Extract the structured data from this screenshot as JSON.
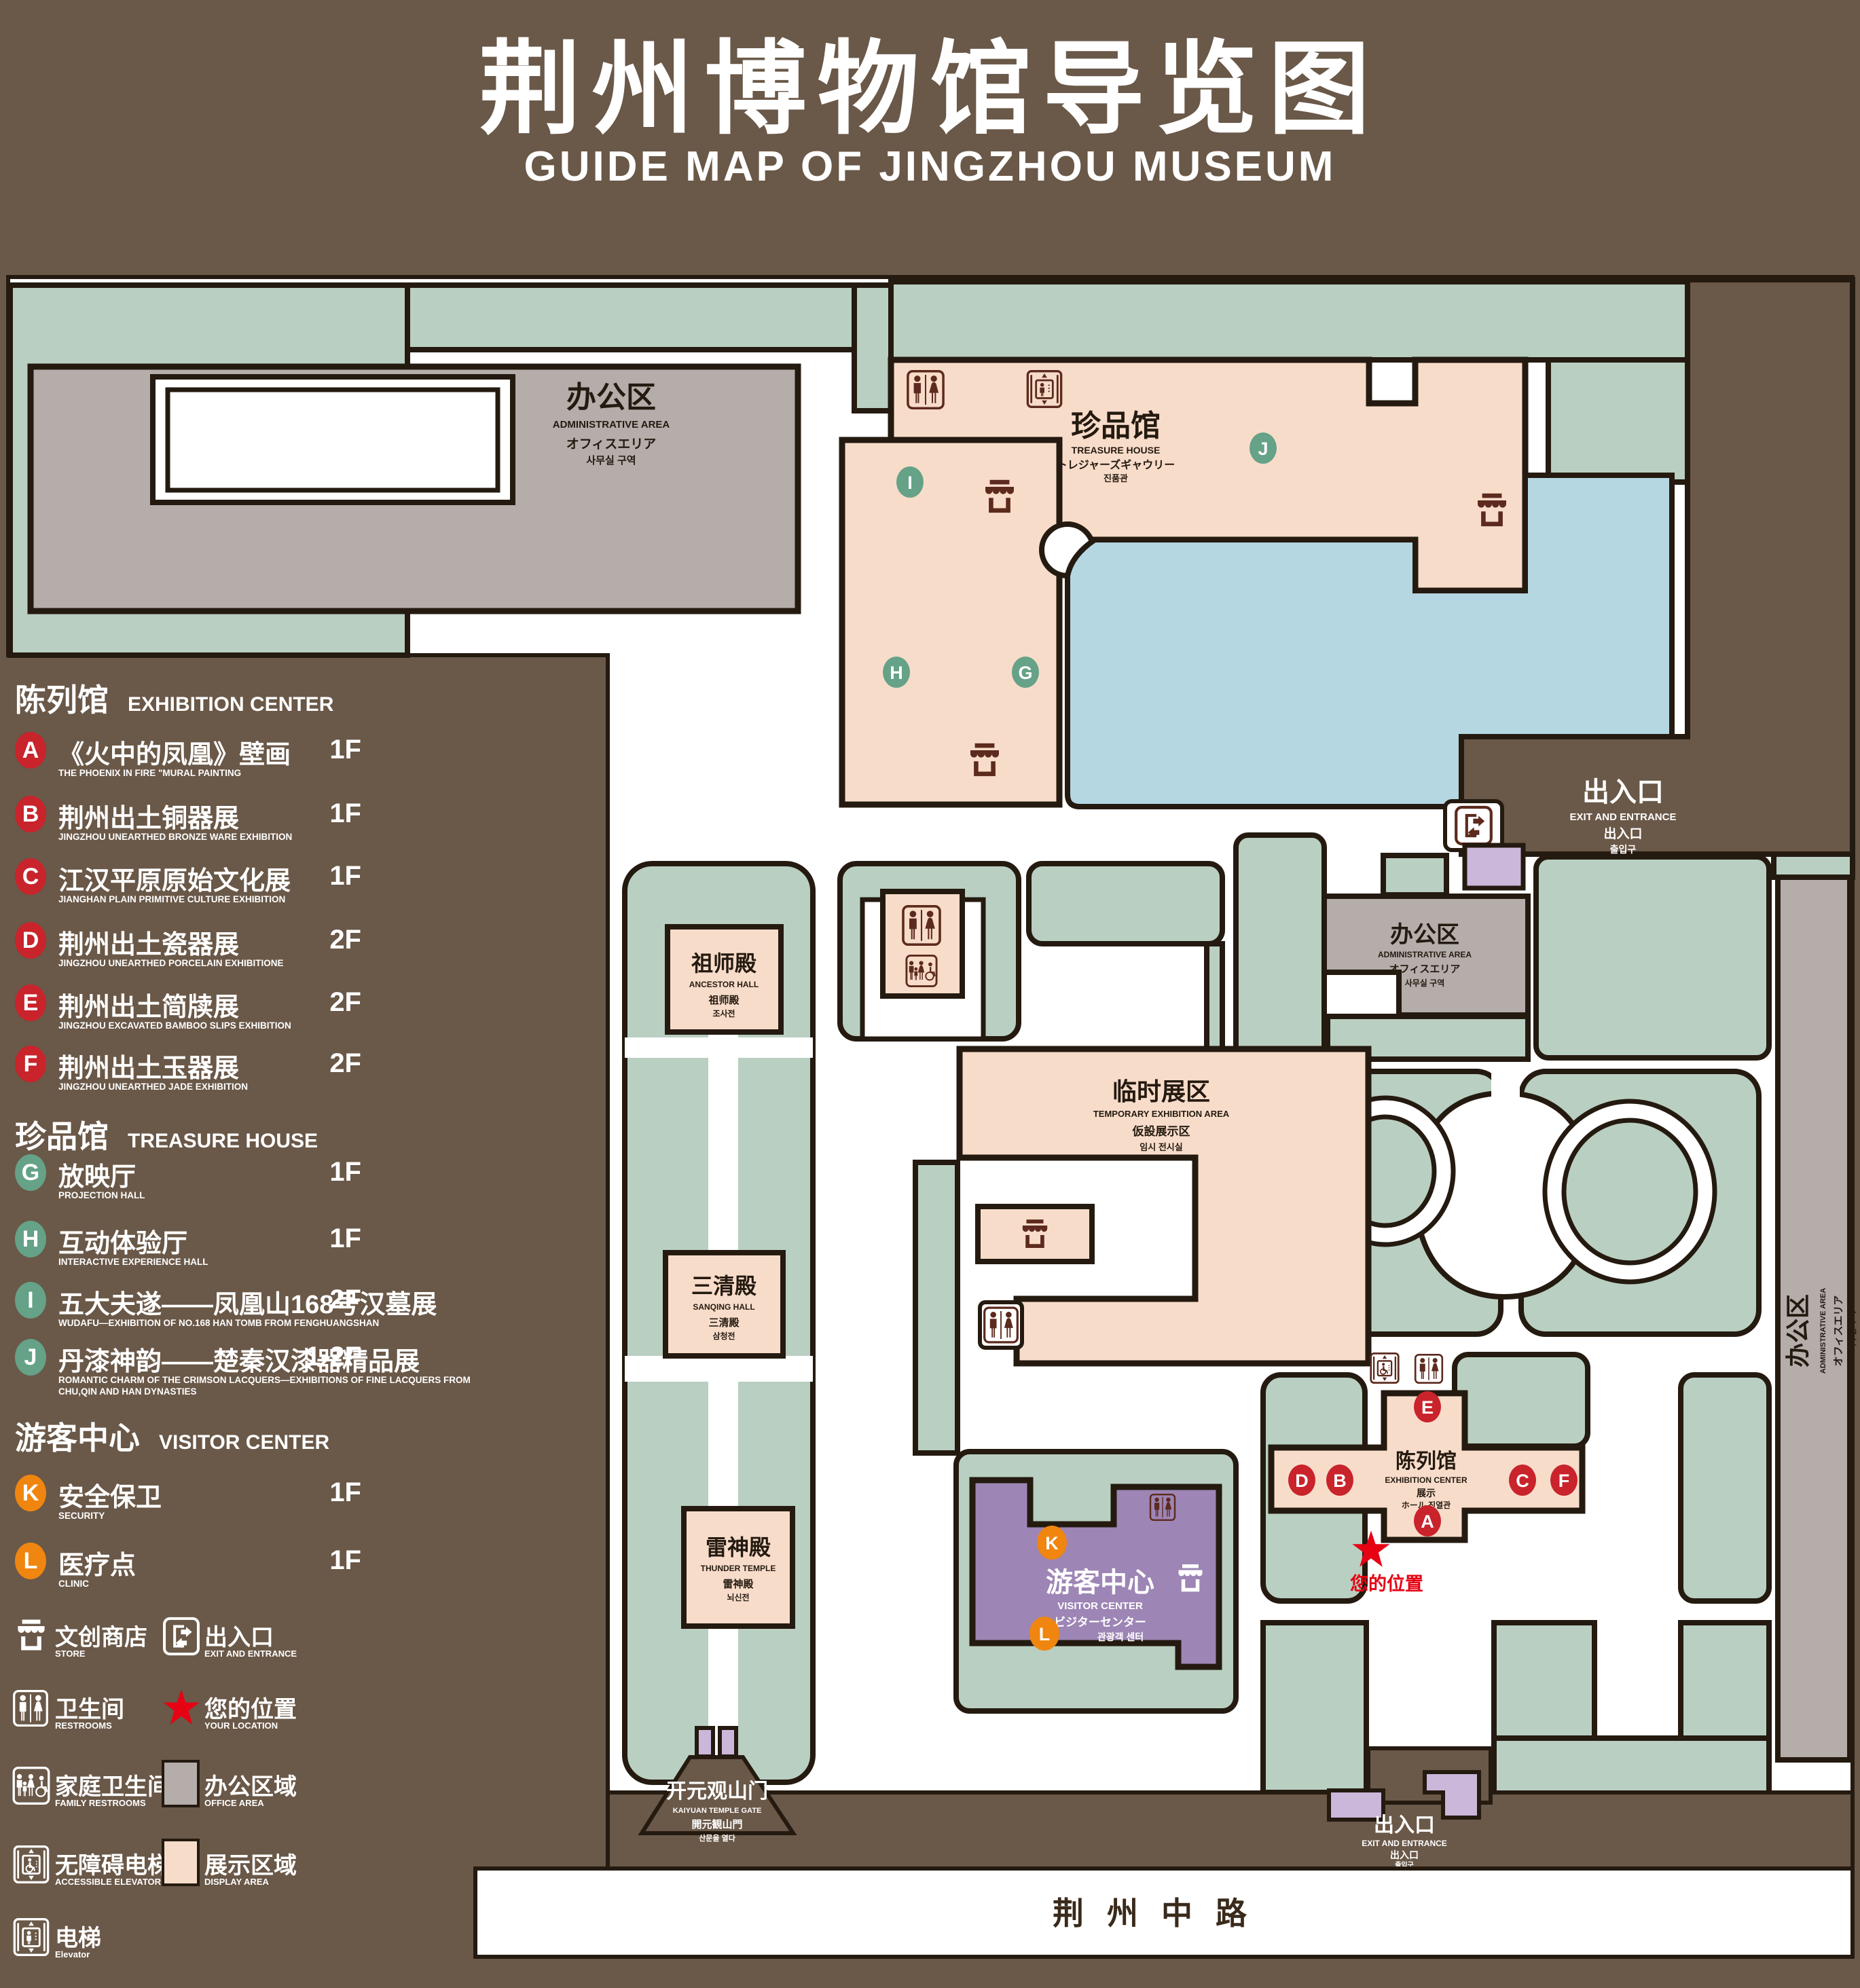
{
  "title": {
    "cn": "荆州博物馆导览图",
    "en": "GUIDE MAP OF JINGZHOU MUSEUM"
  },
  "colors": {
    "background": "#6a5848",
    "green": "#b9cfc1",
    "pink": "#f8dcca",
    "gray": "#b4adaa",
    "purple": "#9d85b5",
    "light_purple": "#cbb7da",
    "pond_blue": "#b5d7e2",
    "outline": "#241a10",
    "marker_red": "#c9232c",
    "marker_green": "#65a287",
    "marker_orange": "#f0860f",
    "star_red": "#e60113",
    "icon_brown": "#5c2a1e"
  },
  "letters": {
    "A": "A",
    "B": "B",
    "C": "C",
    "D": "D",
    "E": "E",
    "F": "F",
    "G": "G",
    "H": "H",
    "I": "I",
    "J": "J",
    "K": "K",
    "L": "L"
  },
  "legend": {
    "sections": [
      {
        "cn": "陈列馆",
        "en": "EXHIBITION CENTER",
        "items": [
          {
            "key": "A",
            "cn": "《火中的凤凰》壁画",
            "en": "THE PHOENIX IN FIRE \"MURAL PAINTING",
            "floor": "1F"
          },
          {
            "key": "B",
            "cn": "荆州出土铜器展",
            "en": "JINGZHOU UNEARTHED BRONZE WARE EXHIBITION",
            "floor": "1F"
          },
          {
            "key": "C",
            "cn": "江汉平原原始文化展",
            "en": "JIANGHAN PLAIN PRIMITIVE CULTURE EXHIBITION",
            "floor": "1F"
          },
          {
            "key": "D",
            "cn": "荆州出土瓷器展",
            "en": "JINGZHOU UNEARTHED PORCELAIN EXHIBITIONE",
            "floor": "2F"
          },
          {
            "key": "E",
            "cn": "荆州出土简牍展",
            "en": "JINGZHOU EXCAVATED BAMBOO SLIPS EXHIBITION",
            "floor": "2F"
          },
          {
            "key": "F",
            "cn": "荆州出土玉器展",
            "en": "JINGZHOU UNEARTHED JADE EXHIBITION",
            "floor": "2F"
          }
        ]
      },
      {
        "cn": "珍品馆",
        "en": "TREASURE HOUSE",
        "items": [
          {
            "key": "G",
            "cn": "放映厅",
            "en": "PROJECTION HALL",
            "floor": "1F"
          },
          {
            "key": "H",
            "cn": "互动体验厅",
            "en": "INTERACTIVE EXPERIENCE HALL",
            "floor": "1F"
          },
          {
            "key": "I",
            "cn": "五大夫遂——凤凰山168号汉墓展",
            "en": "WUDAFU—EXHIBITION OF NO.168 HAN TOMB FROM FENGHUANGSHAN",
            "floor": "2F"
          },
          {
            "key": "J",
            "cn": "丹漆神韵——楚秦汉漆器精品展",
            "en": "ROMANTIC CHARM OF THE CRIMSON LACQUERS—EXHIBITIONS OF FINE LACQUERS FROM CHU,QIN AND HAN DYNASTIES",
            "floor": "1-2F"
          }
        ]
      },
      {
        "cn": "游客中心",
        "en": "VISITOR CENTER",
        "items": [
          {
            "key": "K",
            "cn": "安全保卫",
            "en": "SECURITY",
            "floor": "1F"
          },
          {
            "key": "L",
            "cn": "医疗点",
            "en": "CLINIC",
            "floor": "1F"
          }
        ]
      }
    ],
    "pictos": [
      {
        "icon": "store-icon",
        "cn": "文创商店",
        "en": "STORE"
      },
      {
        "icon": "exit-icon",
        "cn": "出入口",
        "en": "EXIT AND ENTRANCE"
      },
      {
        "icon": "restroom-icon",
        "cn": "卫生间",
        "en": "RESTROOMS"
      },
      {
        "icon": "location-star-icon",
        "cn": "您的位置",
        "en": "YOUR LOCATION"
      },
      {
        "icon": "family-restroom-icon",
        "cn": "家庭卫生间",
        "en": "FAMILY RESTROOMS"
      },
      {
        "icon": "office-area-swatch",
        "cn": "办公区域",
        "en": "OFFICE AREA"
      },
      {
        "icon": "accessible-elevator-icon",
        "cn": "无障碍电梯",
        "en": "ACCESSIBLE ELEVATOR"
      },
      {
        "icon": "display-area-swatch",
        "cn": "展示区域",
        "en": "DISPLAY AREA"
      },
      {
        "icon": "elevator-icon",
        "cn": "电梯",
        "en": "Elevator"
      }
    ]
  },
  "map": {
    "admin_area": {
      "cn": "办公区",
      "en": "ADMINISTRATIVE AREA",
      "jp": "オフィスエリア",
      "kr": "사무실 구역"
    },
    "treasure_house": {
      "cn": "珍品馆",
      "en": "TREASURE HOUSE",
      "jp": "トレジャーズギャウリー",
      "kr": "진품관"
    },
    "exit_gate": {
      "cn": "出入口",
      "en": "EXIT AND ENTRANCE",
      "jp": "出入口",
      "kr": "출입구"
    },
    "ancestor_hall": {
      "cn": "祖师殿",
      "en": "ANCESTOR HALL",
      "cn2": "祖师殿",
      "kr": "조사전"
    },
    "temporary_area": {
      "cn": "临时展区",
      "en": "TEMPORARY EXHIBITION AREA",
      "jp": "仮設展示区",
      "kr": "임시 전시실"
    },
    "sanqing_hall": {
      "cn": "三清殿",
      "en": "SANQING HALL",
      "cn2": "三清殿",
      "kr": "삼청전"
    },
    "thunder_temple": {
      "cn": "雷神殿",
      "en": "THUNDER TEMPLE",
      "cn2": "雷神殿",
      "kr": "뇌신전"
    },
    "exhibition_center": {
      "cn": "陈列馆",
      "en": "EXHIBITION CENTER",
      "jp": "展示",
      "kr": "ホール 진열관"
    },
    "visitor_center": {
      "cn": "游客中心",
      "en": "VISITOR CENTER",
      "jp": "ビジターセンター",
      "kr": "관광객 센터"
    },
    "your_location": {
      "cn": "您的位置"
    },
    "kaiyuan_gate": {
      "cn": "开元观山门",
      "en": "KAIYUAN TEMPLE GATE",
      "jp": "開元観山門",
      "kr": "산문을 열다"
    },
    "road": {
      "cn": "荆州中路"
    }
  }
}
